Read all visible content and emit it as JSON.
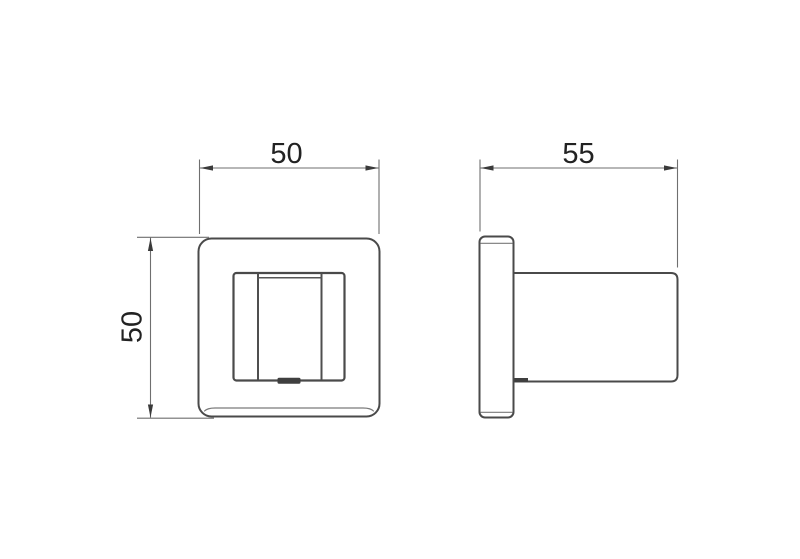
{
  "drawing": {
    "background_color": "#ffffff",
    "object_line_color": "#4a4a4a",
    "dimension_line_color": "#6f6f6f",
    "text_color": "#222222",
    "views": {
      "front": {
        "name": "front-view",
        "width_dim": {
          "label": "50",
          "orientation": "horizontal"
        },
        "height_dim": {
          "label": "50",
          "orientation": "vertical"
        }
      },
      "side": {
        "name": "side-view",
        "depth_dim": {
          "label": "55",
          "orientation": "horizontal"
        }
      }
    }
  }
}
